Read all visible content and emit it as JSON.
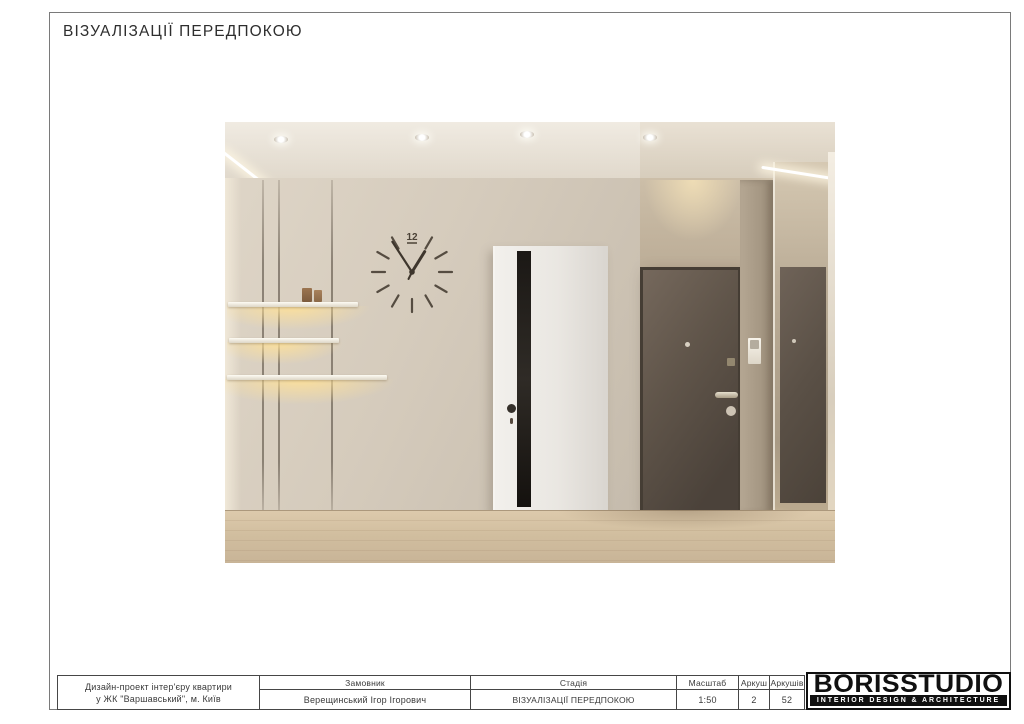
{
  "page": {
    "title": "ВІЗУАЛІЗАЦІЇ ПЕРЕДПОКОЮ"
  },
  "render": {
    "clock_numeral": "12"
  },
  "titleblock": {
    "project_line1": "Дизайн-проект інтер'єру квартири",
    "project_line2": "у ЖК \"Варшавський\", м. Київ",
    "client_label": "Замовник",
    "client_value": "Верещинський Ігор Ігорович",
    "stage_label": "Стадія",
    "stage_value": "ВІЗУАЛІЗАЦІЇ ПЕРЕДПОКОЮ",
    "scale_label": "Масштаб",
    "scale_value": "1:50",
    "sheet_label": "Аркуш",
    "sheet_value": "2",
    "total_sheets_label": "Аркушів",
    "total_sheets_value": "52"
  },
  "logo": {
    "name": "BORISSTUDIO",
    "tagline": "INTERIOR DESIGN & ARCHITECTURE"
  },
  "colors": {
    "wall": "#d2c9bb",
    "glow": "#f5dfa8",
    "dark_door": "#5d5248",
    "floor": "#d3c0a2",
    "table_line": "#464646"
  }
}
